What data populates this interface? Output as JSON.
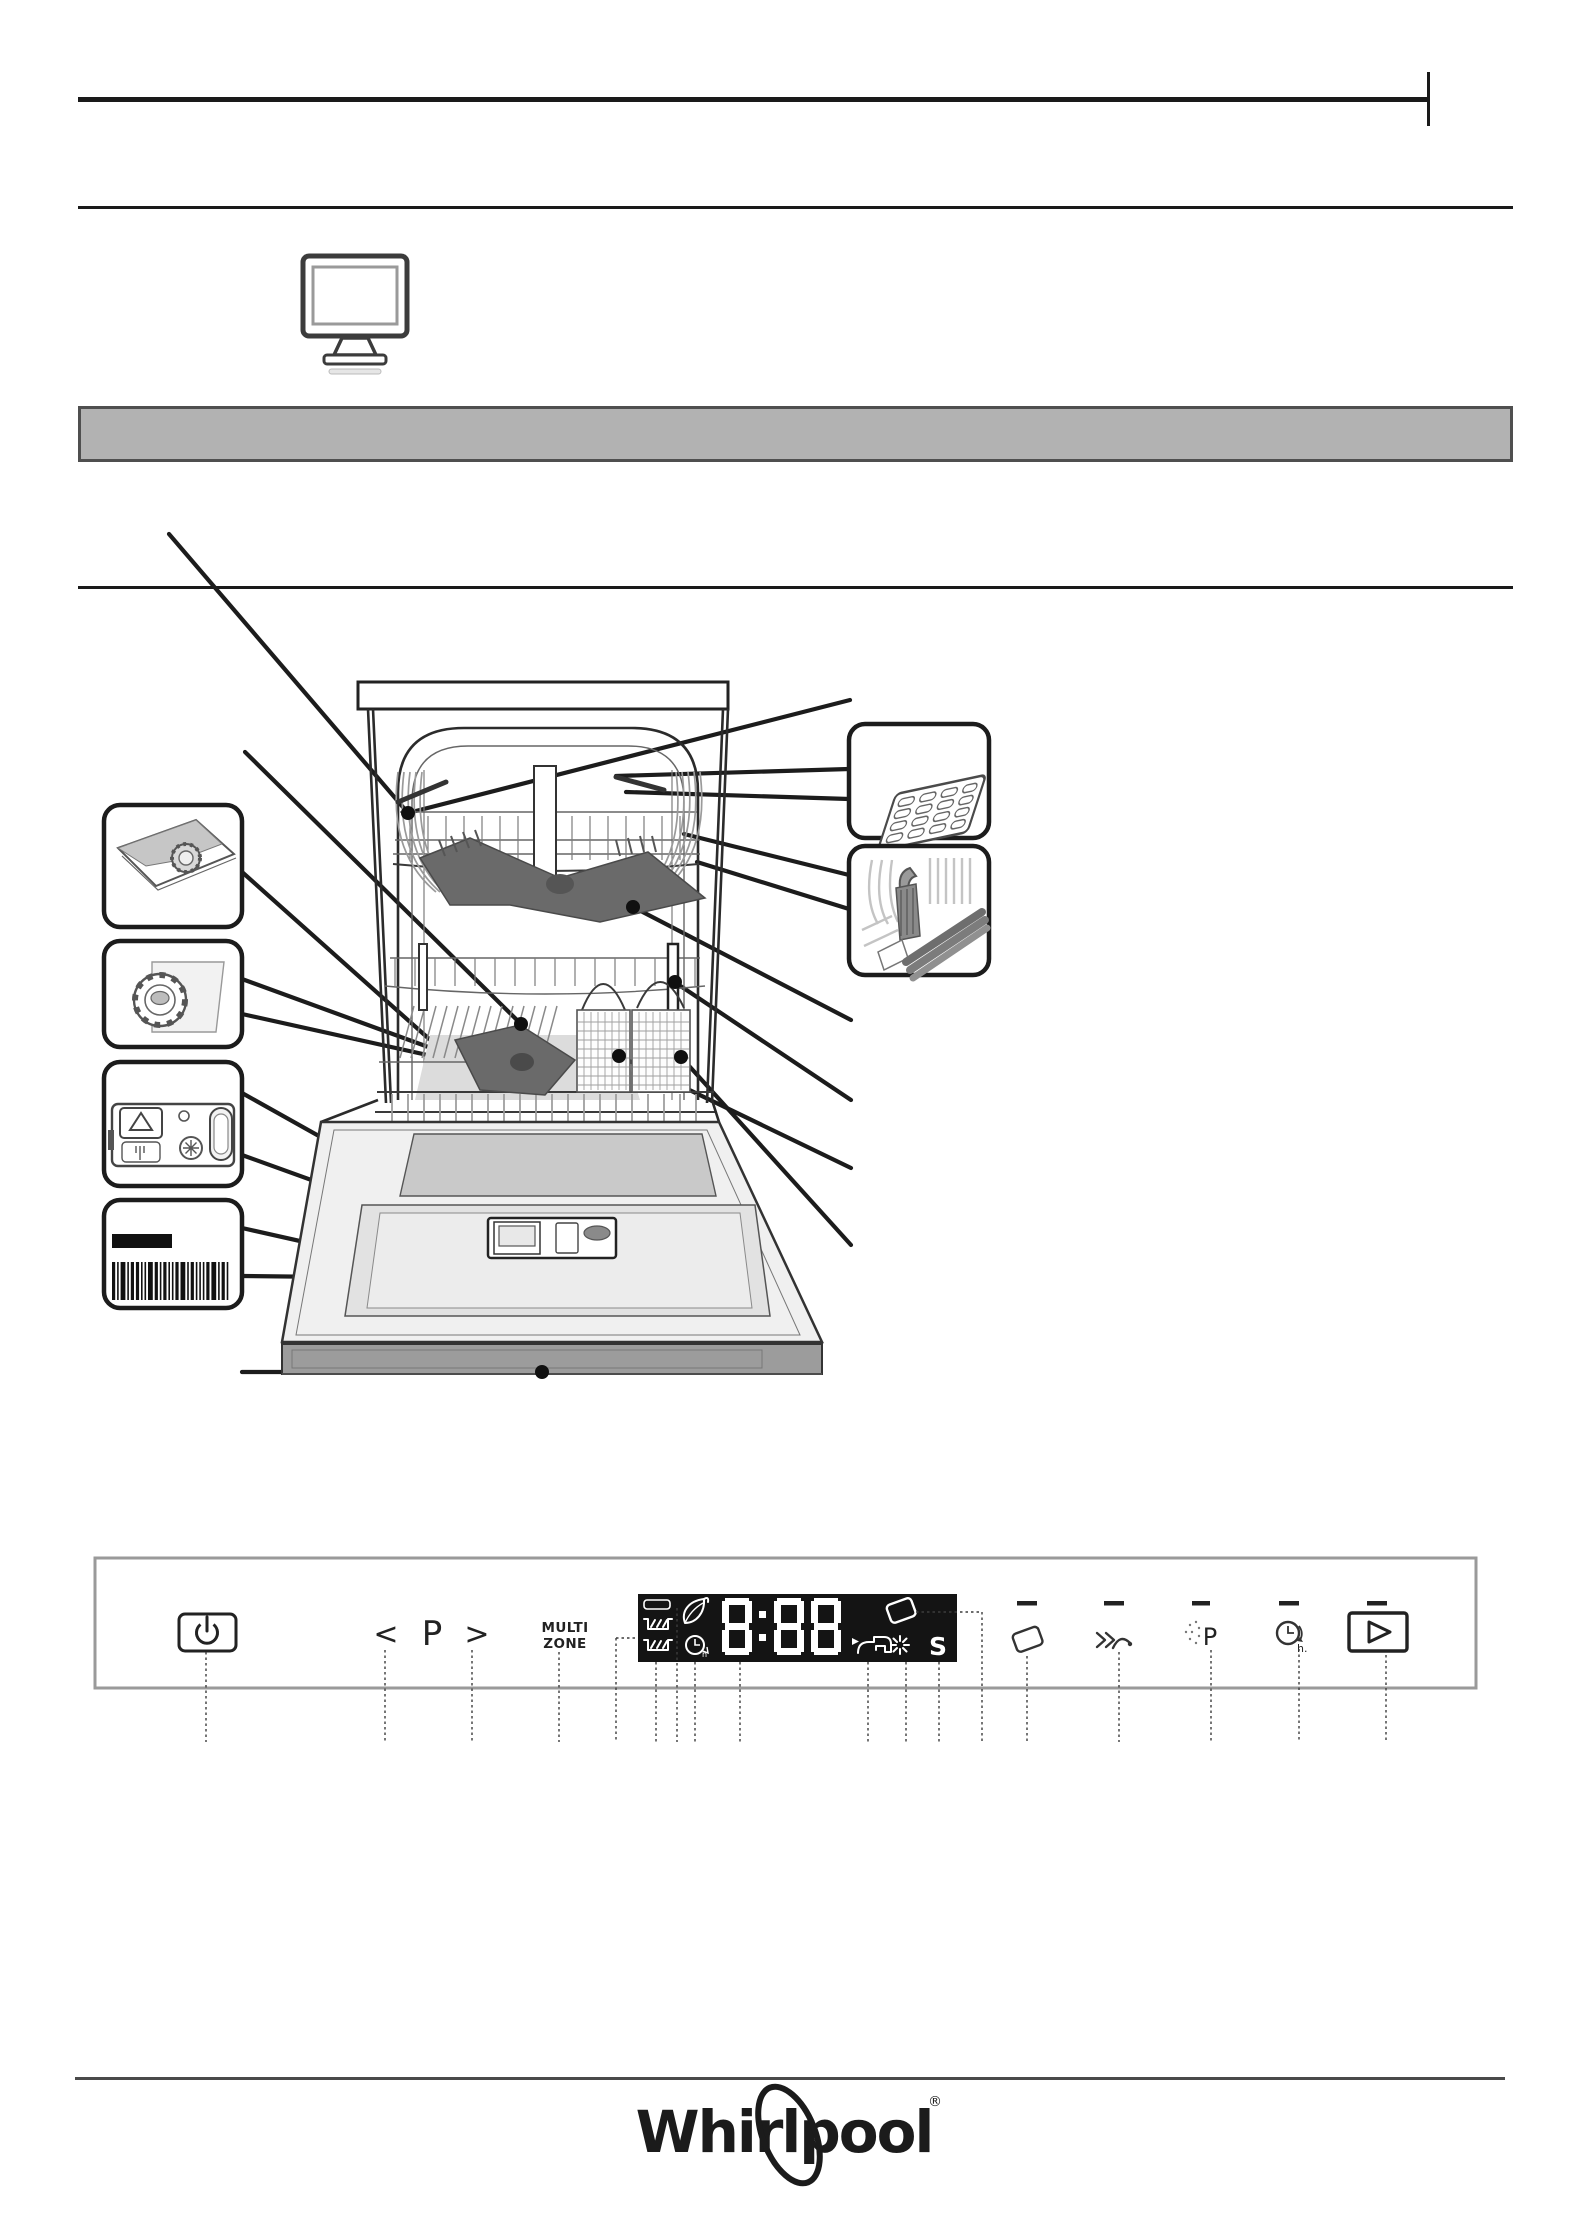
{
  "page": {
    "background": "#ffffff",
    "banner_color": "#b2b2b2",
    "banner_border_color": "#4f4f4f",
    "line_color": "#1a1a1a"
  },
  "icons": {
    "monitor": "monitor-icon",
    "power": "power-icon",
    "chevron_left": "chevron-left-icon",
    "chevron_right": "chevron-right-icon",
    "eco_leaf": "eco-leaf-icon",
    "delay_clock": "delay-clock-icon",
    "water_tap": "water-tap-icon",
    "rinse_aid_star": "rinse-aid-star-icon",
    "salt": "salt-indicator",
    "tablet": "tablet-icon",
    "turbo": "double-chevron-arc-icon",
    "powerclean": "sparkle-p-icon",
    "start_play": "play-icon",
    "upper_rack": "upper-rack-icon",
    "lower_rack": "lower-rack-icon",
    "barcode": "barcode",
    "rating_plate": "rating-plate"
  },
  "control_panel": {
    "program_prev_label": "<",
    "program_letter": "P",
    "program_next_label": ">",
    "multizone_line1": "MULTI",
    "multizone_line2": "ZONE",
    "powerclean_letter": "P",
    "delay_hour_label": "h.",
    "display": {
      "time_value": "8:88",
      "salt_indicator_label": "S",
      "clock_hour_label": "h",
      "background": "#141414",
      "foreground": "#ffffff"
    }
  },
  "footer": {
    "logo_text": "Whirlpool",
    "registered_mark": "®"
  }
}
